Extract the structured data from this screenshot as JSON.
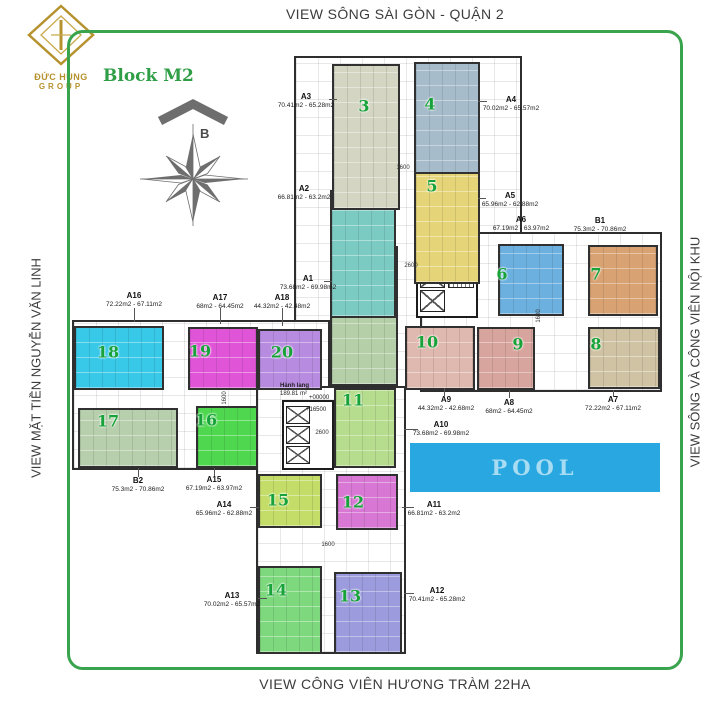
{
  "titles": {
    "top": "VIEW SÔNG SÀI GÒN - QUẬN 2",
    "bottom": "VIEW CÔNG VIÊN HƯƠNG TRÀM 22HA",
    "left": "VIEW MẶT TIỀN NGUYỄN VĂN LINH",
    "right": "VIEW SÔNG VÀ CÔNG VIÊN NỘI KHU"
  },
  "logo": {
    "name": "ĐỨC HÙNG",
    "group": "GROUP"
  },
  "block_label": "Block M2",
  "compass_label": "B",
  "pool": {
    "label": "POOL",
    "color": "#29a7e0"
  },
  "corridor": {
    "name": "Hành lang",
    "area": "189.81 m²",
    "levels": [
      "+00000",
      "+16500"
    ]
  },
  "colors": {
    "frame_green": "#3aa34d",
    "number_green": "#17a339",
    "block_green": "#2f9e46",
    "logo_gold": "#b6922e",
    "title_gray": "#3c3c3c"
  },
  "plan": {
    "slabs": [
      {
        "x": 294,
        "y": 56,
        "w": 228,
        "h": 334
      },
      {
        "x": 420,
        "y": 232,
        "w": 242,
        "h": 160
      },
      {
        "x": 72,
        "y": 320,
        "w": 258,
        "h": 150
      },
      {
        "x": 256,
        "y": 386,
        "w": 150,
        "h": 268
      }
    ],
    "cores": [
      {
        "x": 416,
        "y": 240,
        "w": 62,
        "h": 78
      },
      {
        "x": 282,
        "y": 400,
        "w": 52,
        "h": 70
      }
    ],
    "elevators": [
      {
        "x": 420,
        "y": 246,
        "w": 25,
        "h": 20
      },
      {
        "x": 420,
        "y": 268,
        "w": 25,
        "h": 20
      },
      {
        "x": 420,
        "y": 290,
        "w": 25,
        "h": 22
      },
      {
        "x": 286,
        "y": 406,
        "w": 24,
        "h": 18
      },
      {
        "x": 286,
        "y": 426,
        "w": 24,
        "h": 18
      },
      {
        "x": 286,
        "y": 446,
        "w": 24,
        "h": 18
      }
    ],
    "stairs": [
      {
        "x": 448,
        "y": 258,
        "w": 26,
        "h": 30
      }
    ],
    "units": [
      {
        "num": "1",
        "x": 330,
        "y": 246,
        "w": 68,
        "h": 140,
        "color": "#b5cfa8",
        "nx": 364,
        "ny": 288
      },
      {
        "num": "2",
        "x": 330,
        "y": 190,
        "w": 66,
        "h": 128,
        "color": "#7ccbc3",
        "nx": 364,
        "ny": 202
      },
      {
        "num": "3",
        "x": 332,
        "y": 64,
        "w": 68,
        "h": 146,
        "color": "#d4d6c3",
        "nx": 364,
        "ny": 106
      },
      {
        "num": "4",
        "x": 414,
        "y": 62,
        "w": 66,
        "h": 146,
        "color": "#a7bcca",
        "nx": 430,
        "ny": 104
      },
      {
        "num": "5",
        "x": 414,
        "y": 172,
        "w": 66,
        "h": 112,
        "color": "#e5d578",
        "nx": 432,
        "ny": 186
      },
      {
        "num": "6",
        "x": 498,
        "y": 244,
        "w": 66,
        "h": 72,
        "color": "#6cb0e0",
        "nx": 502,
        "ny": 274
      },
      {
        "num": "7",
        "x": 588,
        "y": 245,
        "w": 70,
        "h": 71,
        "color": "#d9a273",
        "nx": 596,
        "ny": 274
      },
      {
        "num": "8",
        "x": 588,
        "y": 327,
        "w": 72,
        "h": 62,
        "color": "#cfc3a3",
        "nx": 596,
        "ny": 344
      },
      {
        "num": "9",
        "x": 477,
        "y": 327,
        "w": 58,
        "h": 63,
        "color": "#d7a59d",
        "nx": 518,
        "ny": 344
      },
      {
        "num": "10",
        "x": 405,
        "y": 326,
        "w": 70,
        "h": 64,
        "color": "#dfb9b0",
        "nx": 427,
        "ny": 342
      },
      {
        "num": "11",
        "x": 334,
        "y": 388,
        "w": 62,
        "h": 80,
        "color": "#b6dd8d",
        "nx": 353,
        "ny": 400
      },
      {
        "num": "12",
        "x": 336,
        "y": 474,
        "w": 62,
        "h": 56,
        "color": "#d878d4",
        "nx": 353,
        "ny": 502
      },
      {
        "num": "13",
        "x": 334,
        "y": 572,
        "w": 68,
        "h": 82,
        "color": "#9b9bdd",
        "nx": 350,
        "ny": 596
      },
      {
        "num": "14",
        "x": 258,
        "y": 566,
        "w": 64,
        "h": 88,
        "color": "#7ed87e",
        "nx": 276,
        "ny": 590
      },
      {
        "num": "15",
        "x": 258,
        "y": 474,
        "w": 64,
        "h": 54,
        "color": "#c3dd68",
        "nx": 278,
        "ny": 500
      },
      {
        "num": "16",
        "x": 196,
        "y": 406,
        "w": 62,
        "h": 62,
        "color": "#4fd74f",
        "nx": 206,
        "ny": 420
      },
      {
        "num": "17",
        "x": 78,
        "y": 408,
        "w": 100,
        "h": 60,
        "color": "#b8cfad",
        "nx": 108,
        "ny": 421
      },
      {
        "num": "18",
        "x": 74,
        "y": 326,
        "w": 90,
        "h": 64,
        "color": "#38c8e8",
        "nx": 108,
        "ny": 352
      },
      {
        "num": "19",
        "x": 188,
        "y": 327,
        "w": 70,
        "h": 63,
        "color": "#e055d8",
        "nx": 200,
        "ny": 351
      },
      {
        "num": "20",
        "x": 258,
        "y": 329,
        "w": 64,
        "h": 61,
        "color": "#b78ce0",
        "nx": 282,
        "ny": 352
      }
    ],
    "apartments": [
      {
        "code": "A1",
        "range": "73.68m2 - 69.98m2",
        "cx": 308,
        "y": 274
      },
      {
        "code": "A2",
        "range": "66.81m2 - 63.2m2",
        "cx": 304,
        "y": 184
      },
      {
        "code": "A3",
        "range": "70.41m2 - 65.28m2",
        "cx": 306,
        "y": 92
      },
      {
        "code": "A4",
        "range": "70.02m2 - 65.57m2",
        "cx": 511,
        "y": 95
      },
      {
        "code": "A5",
        "range": "65.96m2 - 62.88m2",
        "cx": 510,
        "y": 191
      },
      {
        "code": "A6",
        "range": "67.19m2 - 63.97m2",
        "cx": 521,
        "y": 215
      },
      {
        "code": "B1",
        "range": "75.3m2 - 70.86m2",
        "cx": 600,
        "y": 216
      },
      {
        "code": "A7",
        "range": "72.22m2 - 67.11m2",
        "cx": 613,
        "y": 395
      },
      {
        "code": "A8",
        "range": "68m2 - 64.45m2",
        "cx": 509,
        "y": 398
      },
      {
        "code": "A9",
        "range": "44.32m2 - 42.68m2",
        "cx": 446,
        "y": 395
      },
      {
        "code": "A10",
        "range": "73.68m2 - 69.98m2",
        "cx": 441,
        "y": 420
      },
      {
        "code": "A11",
        "range": "66.81m2 - 63.2m2",
        "cx": 434,
        "y": 500
      },
      {
        "code": "A12",
        "range": "70.41m2 - 65.28m2",
        "cx": 437,
        "y": 586
      },
      {
        "code": "A13",
        "range": "70.02m2 - 65.57m2",
        "cx": 232,
        "y": 591
      },
      {
        "code": "A14",
        "range": "65.96m2 - 62.88m2",
        "cx": 224,
        "y": 500
      },
      {
        "code": "A15",
        "range": "67.19m2 - 63.97m2",
        "cx": 214,
        "y": 475
      },
      {
        "code": "B2",
        "range": "75.3m2 - 70.86m2",
        "cx": 138,
        "y": 476
      },
      {
        "code": "A16",
        "range": "72.22m2 - 67.11m2",
        "cx": 134,
        "y": 291
      },
      {
        "code": "A17",
        "range": "68m2 - 64.45m2",
        "cx": 220,
        "y": 293
      },
      {
        "code": "A18",
        "range": "44.32m2 - 42.48m2",
        "cx": 282,
        "y": 293
      }
    ],
    "leaders": [
      {
        "x": 324,
        "y": 281,
        "len": 8,
        "v": false
      },
      {
        "x": 329,
        "y": 99,
        "len": 8,
        "v": false
      },
      {
        "x": 478,
        "y": 101,
        "len": 9,
        "v": false
      },
      {
        "x": 478,
        "y": 198,
        "len": 8,
        "v": false
      },
      {
        "x": 134,
        "y": 308,
        "len": 14,
        "v": true
      },
      {
        "x": 220,
        "y": 308,
        "len": 16,
        "v": true
      },
      {
        "x": 282,
        "y": 308,
        "len": 18,
        "v": true
      },
      {
        "x": 444,
        "y": 388,
        "len": 8,
        "v": true
      },
      {
        "x": 509,
        "y": 390,
        "len": 8,
        "v": true
      },
      {
        "x": 613,
        "y": 390,
        "len": 7,
        "v": true
      },
      {
        "x": 404,
        "y": 429,
        "len": 14,
        "v": false
      },
      {
        "x": 402,
        "y": 507,
        "len": 12,
        "v": false
      },
      {
        "x": 404,
        "y": 593,
        "len": 10,
        "v": false
      },
      {
        "x": 258,
        "y": 598,
        "len": 9,
        "v": false
      },
      {
        "x": 250,
        "y": 507,
        "len": 9,
        "v": false
      },
      {
        "x": 214,
        "y": 468,
        "len": 8,
        "v": true
      },
      {
        "x": 138,
        "y": 468,
        "len": 9,
        "v": true
      }
    ],
    "dimensions": [
      {
        "text": "1600",
        "x": 403,
        "y": 168,
        "v": false
      },
      {
        "text": "2600",
        "x": 411,
        "y": 266,
        "v": false
      },
      {
        "text": "1600",
        "x": 539,
        "y": 316,
        "v": true
      },
      {
        "text": "1600",
        "x": 225,
        "y": 398,
        "v": true
      },
      {
        "text": "2600",
        "x": 322,
        "y": 433,
        "v": false
      },
      {
        "text": "1600",
        "x": 328,
        "y": 545,
        "v": false
      }
    ]
  }
}
